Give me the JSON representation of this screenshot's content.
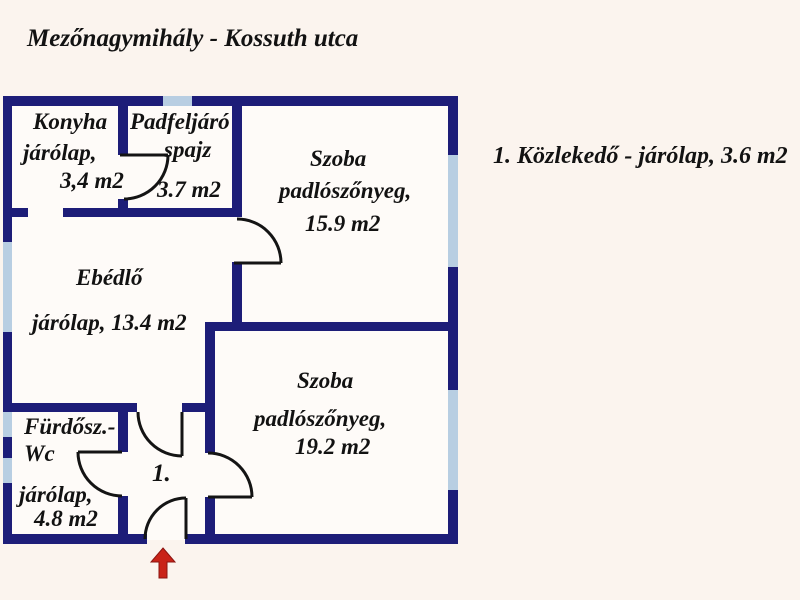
{
  "title": "Mezőnagymihály - Kossuth utca",
  "note": "1. Közlekedő - járólap, 3.6 m2",
  "rooms": {
    "konyha": {
      "lines": [
        "Konyha",
        "járólap,",
        "3,4 m2"
      ]
    },
    "spajz": {
      "lines": [
        "Padfeljáró",
        "spajz",
        "3.7 m2"
      ]
    },
    "szoba1": {
      "lines": [
        "Szoba",
        "padlószőnyeg,",
        "15.9 m2"
      ]
    },
    "ebedlo": {
      "lines": [
        "Ebédlő",
        "járólap, 13.4 m2"
      ]
    },
    "szoba2": {
      "lines": [
        "Szoba",
        "padlószőnyeg,",
        "19.2 m2"
      ]
    },
    "furdo": {
      "lines": [
        "Fürdősz.-",
        "Wc",
        "járólap,",
        "4.8 m2"
      ]
    },
    "hall": {
      "lines": [
        "1."
      ]
    }
  },
  "colors": {
    "wall": "#1d1d78",
    "window": "#b8cee2",
    "background": "#fbf4ee",
    "floor": "#fefbf8",
    "door_line": "#141414",
    "arrow": "#c92318",
    "text": "#121212"
  }
}
